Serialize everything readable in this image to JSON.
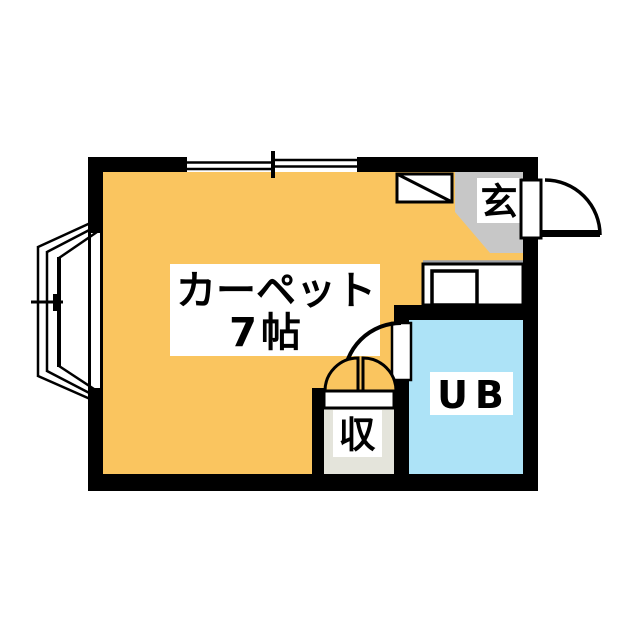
{
  "plan": {
    "rooms": {
      "carpet": {
        "label_line1": "カーペット",
        "label_line2": "7帖",
        "fill": "#FAC55F"
      },
      "genkan": {
        "label": "玄",
        "fill": "#C7C7C7"
      },
      "unit_bath": {
        "label": "UB",
        "fill": "#ADE3F7"
      },
      "storage": {
        "label": "収",
        "fill": "#E4E4DB"
      }
    },
    "palette": {
      "wall": "#000000",
      "fixture": "#FFFFFF",
      "counter_edge_line": "#9CA0A8",
      "line": "#000000",
      "background": "#FFFFFF"
    }
  }
}
